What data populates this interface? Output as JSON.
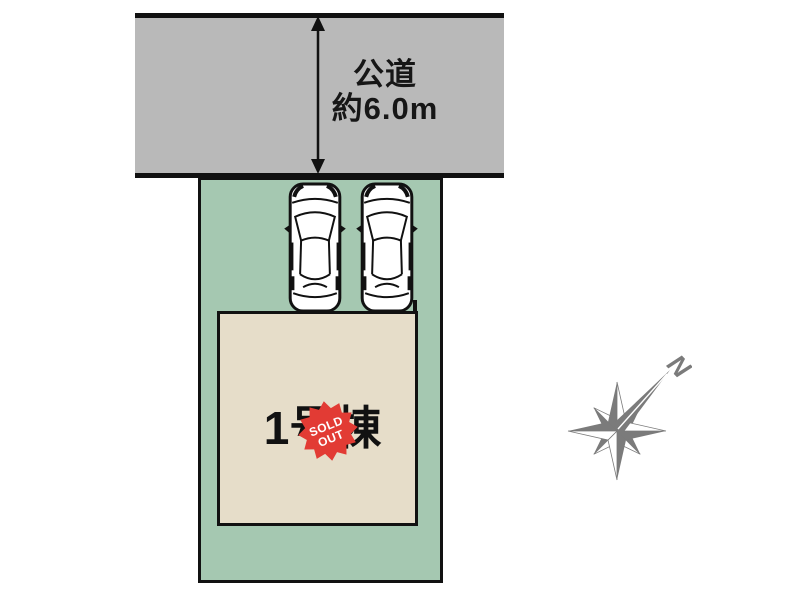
{
  "diagram": {
    "title": "site-plan",
    "road": {
      "label_line1": "公道",
      "label_line2": "約6.0m",
      "fill": "#b9b9b9",
      "border_color": "#111111"
    },
    "plot": {
      "fill": "#a5c8b1",
      "border_color": "#111111"
    },
    "building": {
      "label": "1号棟",
      "fill": "#e6ddc9",
      "border_color": "#111111"
    },
    "sold_out_badge": {
      "line1": "SOLD",
      "line2": "OUT",
      "fill": "#e23b34",
      "text_color": "#ffffff"
    },
    "compass": {
      "label": "N",
      "color": "#7b7b7b"
    },
    "cars": {
      "count": 2
    }
  }
}
